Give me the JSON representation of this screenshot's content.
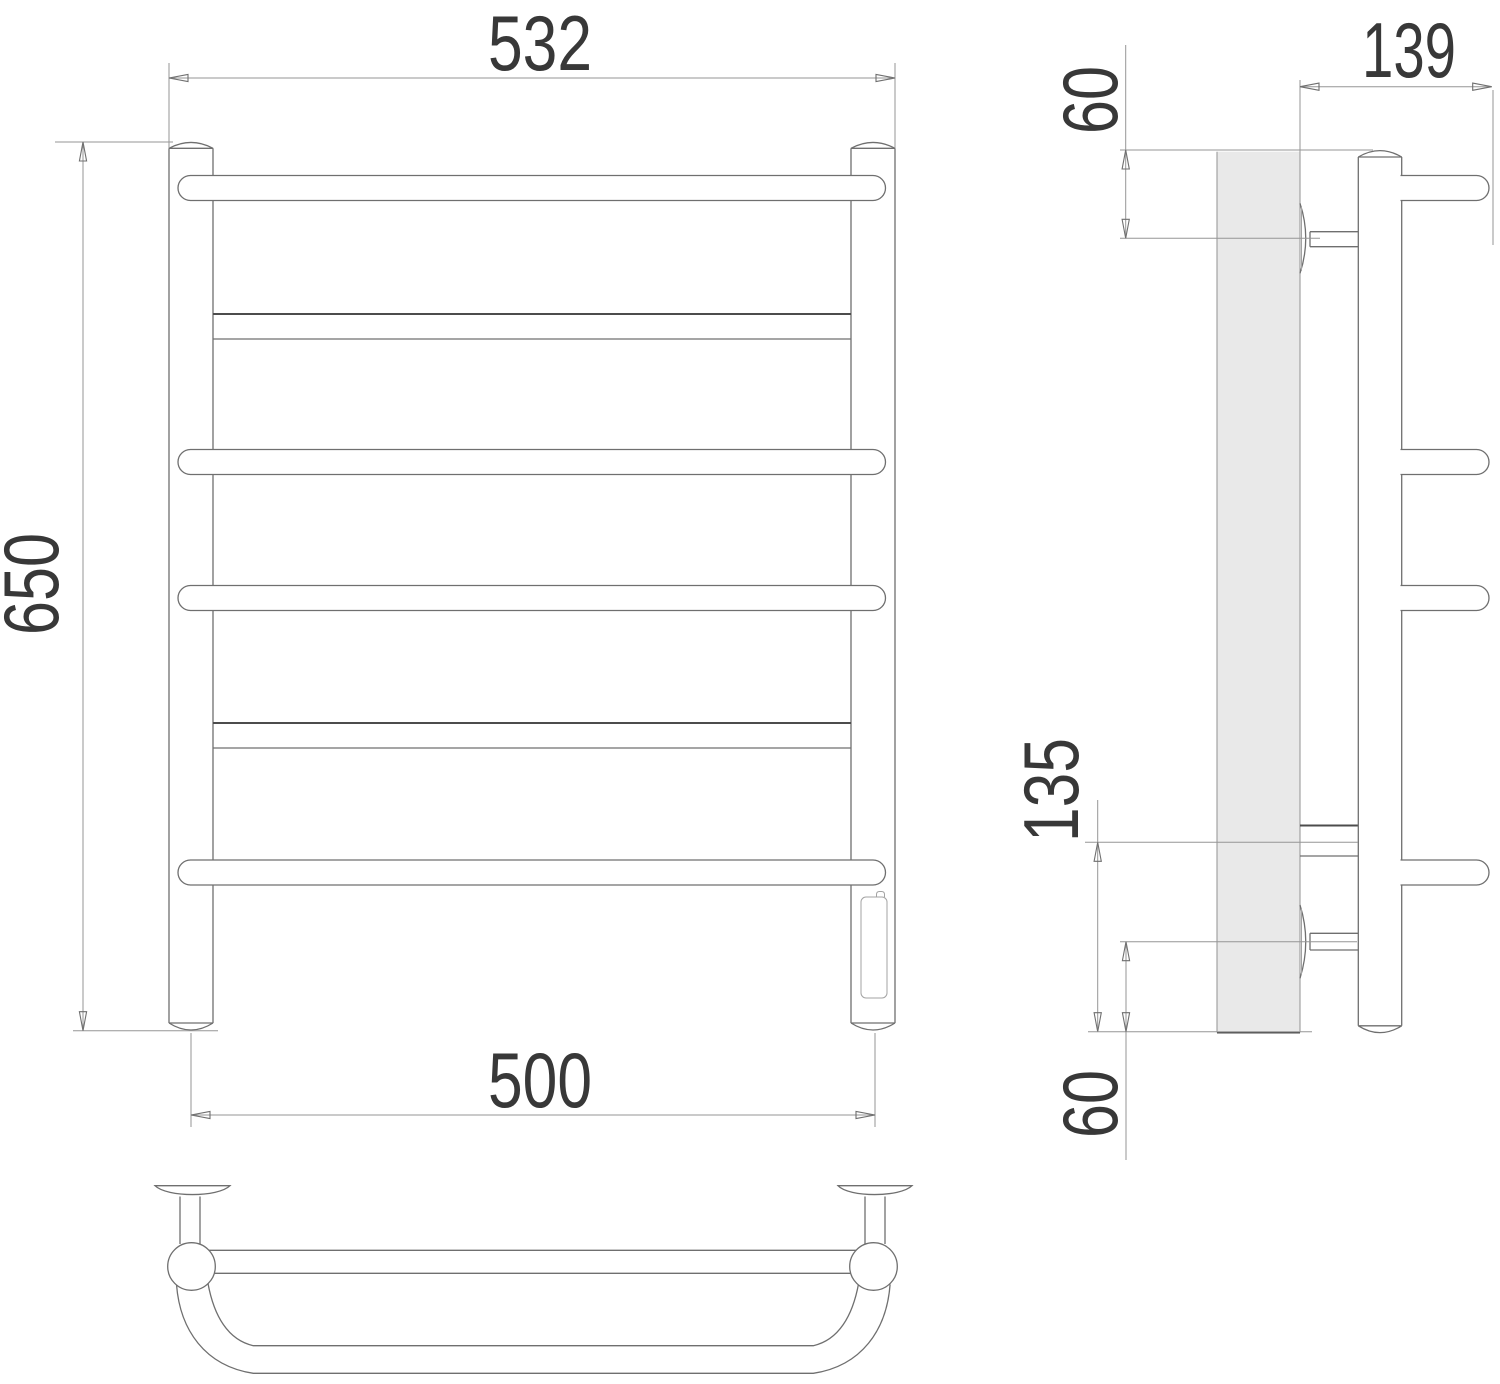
{
  "drawing": {
    "type": "technical-drawing",
    "subject": "ladder towel rail with heating element, three orthographic views"
  },
  "dimensions": {
    "overall_width": "532",
    "overall_height": "650",
    "mounting_width": "500",
    "depth": "139",
    "top_offset": "60",
    "lower_connection_span": "135",
    "bottom_offset": "60"
  },
  "colors": {
    "background": "#ffffff",
    "object_line": "#6f6f6f",
    "dimension_line": "#969696",
    "text": "#383838",
    "wall_fill": "#e9e9e9"
  }
}
